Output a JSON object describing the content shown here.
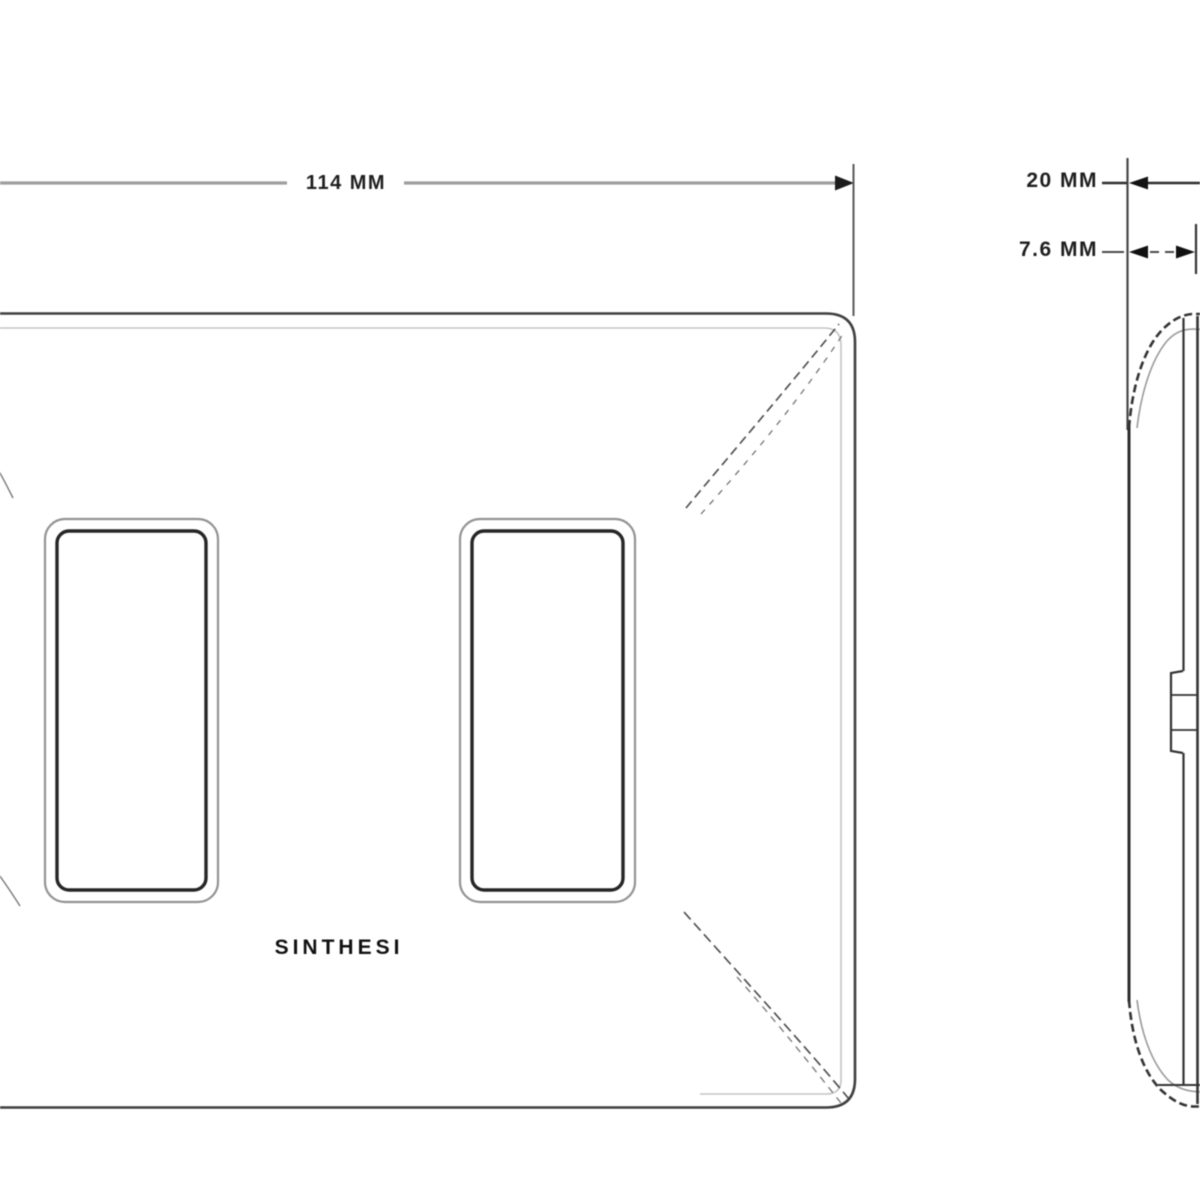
{
  "drawing": {
    "type": "technical-drawing",
    "subject": "wall-plate front and side views",
    "front_view": {
      "width_dimension": "114 MM",
      "brand": "SINTHESI",
      "openings_count": "2"
    },
    "side_view": {
      "total_depth_dimension": "20 MM",
      "plate_depth_dimension": "7.6 MM"
    },
    "colors": {
      "background": "#ffffff",
      "line_dark": "#3a3a3a",
      "line_medium": "#6a6a6a",
      "line_light": "#9e9e9e",
      "bevel_light": "#c0c0c0",
      "text": "#1f1f1f"
    }
  }
}
